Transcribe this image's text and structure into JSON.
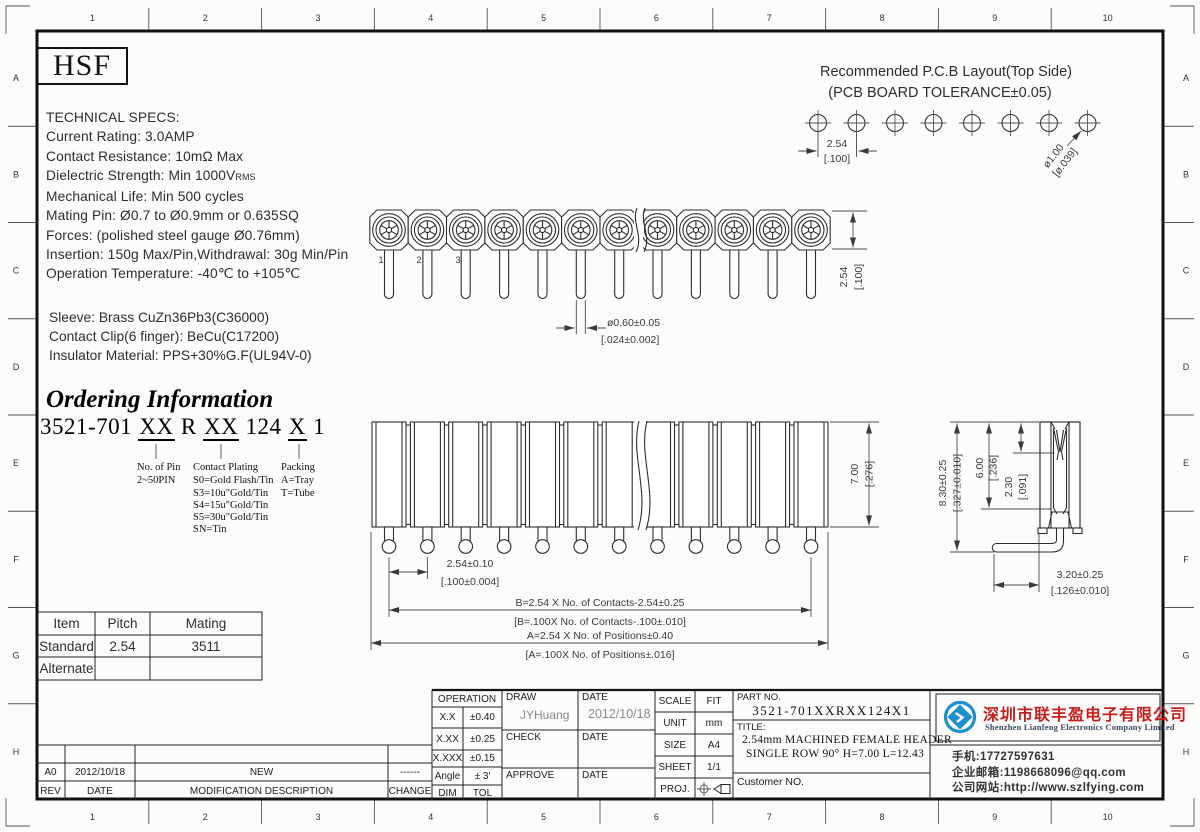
{
  "frame": {
    "column_labels": [
      "1",
      "2",
      "3",
      "4",
      "5",
      "6",
      "7",
      "8",
      "9",
      "10"
    ],
    "row_labels": [
      "A",
      "B",
      "C",
      "D",
      "E",
      "F",
      "G",
      "H"
    ]
  },
  "logo_box": {
    "text": "HSF"
  },
  "specs": {
    "title": "TECHNICAL SPECS:",
    "current": "Current Rating: 3.0AMP",
    "resistance": "Contact Resistance: 10mΩ Max",
    "dielectric": "Dielectric Strength: Min 1000V",
    "dielectric_sub": "RMS",
    "mech_life": "Mechanical Life: Min 500 cycles",
    "mating_pin": "Mating Pin: Ø0.7 to Ø0.9mm or 0.635SQ",
    "forces": "Forces: (polished steel gauge Ø0.76mm)",
    "insertion": "Insertion: 150g Max/Pin,Withdrawal: 30g Min/Pin",
    "temperature": "Operation Temperature: -40℃ to +105℃"
  },
  "materials": {
    "sleeve": "Sleeve: Brass CuZn36Pb3(C36000)",
    "clip": "Contact Clip(6 finger): BeCu(C17200)",
    "insulator": "Insulator Material: PPS+30%G.F(UL94V-0)"
  },
  "ordering": {
    "heading": "Ordering Information",
    "pn_prefix": "3521-701 ",
    "pn_pins": "XX",
    "pn_mid1": " R ",
    "pn_plating": "XX",
    "pn_mid2": " 124 ",
    "pn_packing": "X",
    "pn_suffix": " 1",
    "pins_title": "No. of Pin",
    "pins_range": "2~50PIN",
    "plating_title": "Contact Plating",
    "plating_options": [
      "S0=Gold Flash/Tin",
      "S3=10u\"Gold/Tin",
      "S4=15u\"Gold/Tin",
      "S5=30u\"Gold/Tin",
      "SN=Tin"
    ],
    "packing_title": "Packing",
    "packing_options": [
      "A=Tray",
      "T=Tube"
    ]
  },
  "pcb": {
    "title1": "Recommended P.C.B Layout(Top Side)",
    "title2": "(PCB BOARD TOLERANCE±0.05)",
    "pitch_mm": "2.54",
    "pitch_in": "[.100]",
    "hole_mm": "ø1.00",
    "hole_in": "[ø.039]"
  },
  "top_view": {
    "pin_labels": [
      "1",
      "2",
      "3"
    ],
    "tail_dia_mm": "ø0.60±0.05",
    "tail_dia_in": "[.024±0.002]",
    "width_mm": "2.54",
    "width_in": "[.100]"
  },
  "front_view": {
    "pitch_mm": "2.54±0.10",
    "pitch_in": "[.100±0.004]",
    "height_mm": "7.00",
    "height_in": "[.276]",
    "formula_b_mm": "B=2.54 X No. of Contacts-2.54±0.25",
    "formula_b_in": "[B=.100X No. of Contacts-.100±.010]",
    "formula_a_mm": "A=2.54 X No. of Positions±0.40",
    "formula_a_in": "[A=.100X No. of Positions±.016]"
  },
  "side_view": {
    "total_h_mm": "8.30±0.25",
    "total_h_in": "[.327±0.010]",
    "body_h_mm": "6.00",
    "body_h_in": "[.236]",
    "entry_mm": "2.30",
    "entry_in": "[.091]",
    "tail_len_mm": "3.20±0.25",
    "tail_len_in": "[.126±0.010]"
  },
  "mating_table": {
    "headers": [
      "Item",
      "Pitch",
      "Mating"
    ],
    "rows": [
      [
        "Standard",
        "2.54",
        "3511"
      ],
      [
        "Alternate",
        "",
        ""
      ]
    ]
  },
  "revision_table": {
    "headers": [
      "REV",
      "DATE",
      "MODIFICATION DESCRIPTION",
      "CHANGE"
    ],
    "entry": {
      "rev": "A0",
      "date": "2012/10/18",
      "description": "NEW",
      "change": "------"
    }
  },
  "title_block": {
    "operation": {
      "title": "OPERATION",
      "rows": [
        [
          "X.X",
          "±0.40"
        ],
        [
          "X.XX",
          "±0.25"
        ],
        [
          "X.XXX",
          "±0.15"
        ],
        [
          "Angle",
          "± 3'"
        ],
        [
          "DIM",
          "TOL"
        ]
      ]
    },
    "draw_label": "DRAW",
    "draw_name": "JYHuang",
    "date_label": "DATE",
    "draw_date": "2012/10/18",
    "check_label": "CHECK",
    "approve_label": "APPROVE",
    "scale_label": "SCALE",
    "scale_value": "FIT",
    "unit_label": "UNIT",
    "unit_value": "mm",
    "size_label": "SIZE",
    "size_value": "A4",
    "sheet_label": "SHEET",
    "sheet_value": "1/1",
    "proj_label": "PROJ.",
    "part_no_label": "PART NO.",
    "part_no": "3521-701XXRXX124X1",
    "title_label": "TITLE:",
    "title_line1": "2.54mm MACHINED FEMALE HEADER",
    "title_line2": "SINGLE ROW 90° H=7.00 L=12.43",
    "customer_label": "Customer NO."
  },
  "company": {
    "name_cn": "深圳市联丰盈电子有限公司",
    "name_en": "Shenzhen Lianfeng Electronics Company Limited",
    "phone": "手机:17727597631",
    "email": "企业邮箱:1198668096@qq.com",
    "website": "公司网站:http://www.szlfying.com",
    "accent_red": "#c81e1e",
    "logo_blue": "#1e8fce"
  }
}
